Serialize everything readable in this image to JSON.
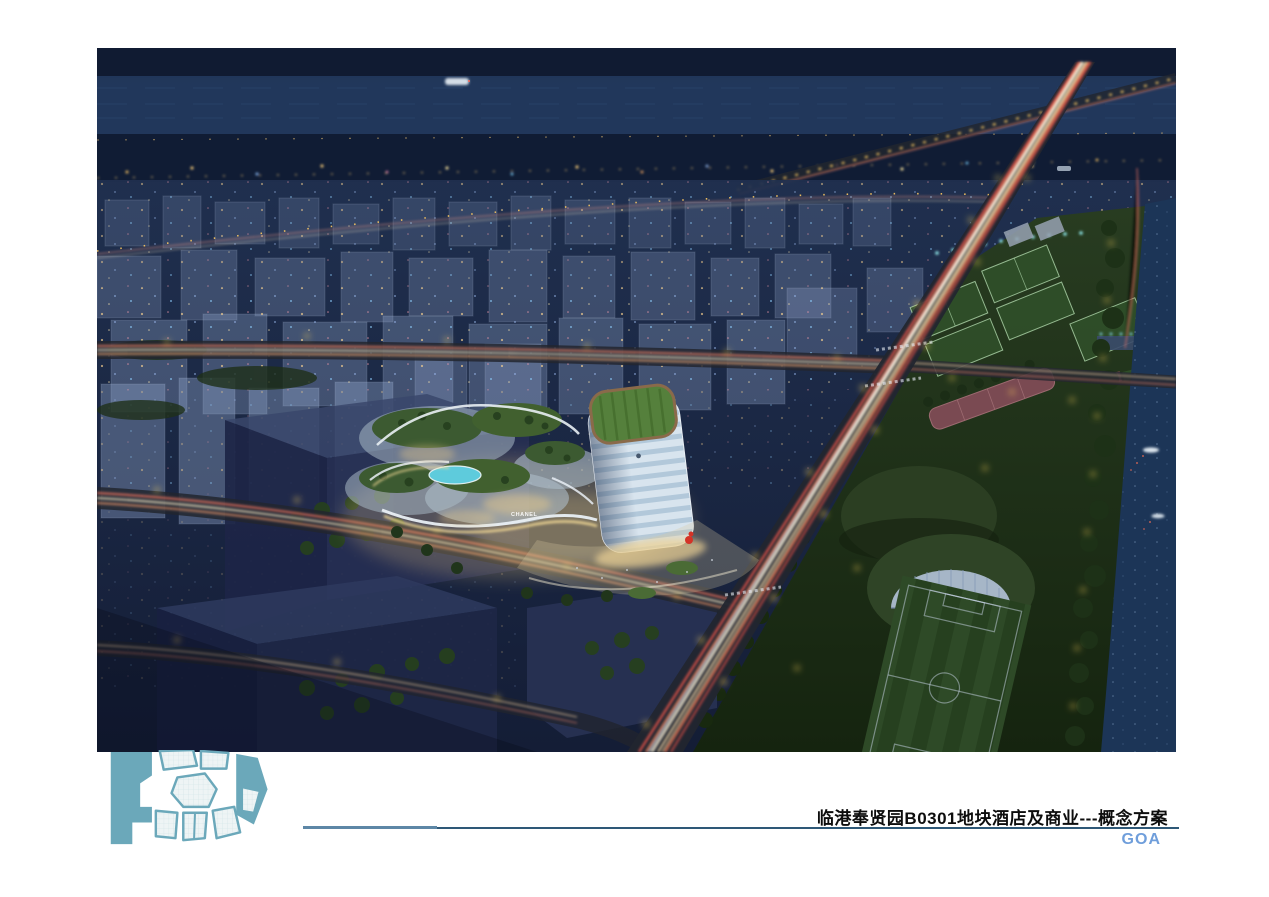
{
  "slide": {
    "title": "临港奉贤园B0301地块酒店及商业---概念方案",
    "brand": "GOA",
    "signs": {
      "storefront": "CHANEL"
    },
    "colors": {
      "brand_blue": "#6f9edb",
      "logo_teal": "#6ba8ba",
      "rule_thick": "#5d87a6",
      "rule_thin": "#2e5877",
      "night_sky": "#16243e",
      "light_trail_red": "#ff5a4e",
      "light_trail_warm": "#ffe2b0",
      "streetlight_yellow": "#ffd65a",
      "park_green": "#22351f",
      "river_blue": "#1c3557"
    }
  }
}
